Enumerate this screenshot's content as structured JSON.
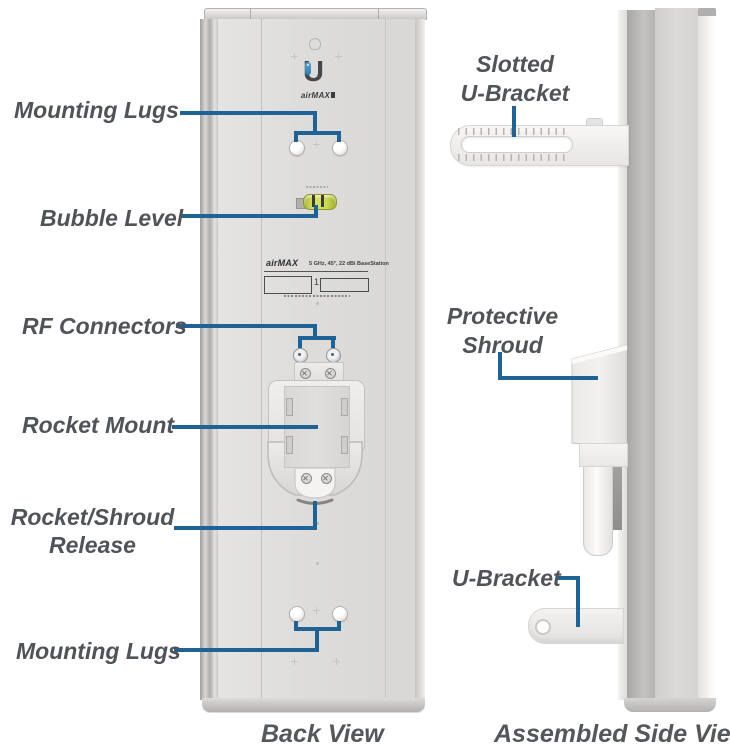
{
  "diagram": {
    "callouts": {
      "mounting_lugs_top": "Mounting Lugs",
      "bubble_level": "Bubble Level",
      "rf_connectors": "RF Connectors",
      "rocket_mount": "Rocket Mount",
      "rocket_shroud_release_line1": "Rocket/Shroud",
      "rocket_shroud_release_line2": "Release",
      "mounting_lugs_bottom": "Mounting Lugs",
      "slotted_u_bracket_line1": "Slotted",
      "slotted_u_bracket_line2": "U-Bracket",
      "protective_shroud_line1": "Protective",
      "protective_shroud_line2": "Shroud",
      "u_bracket": "U-Bracket"
    },
    "captions": {
      "back_view": "Back View",
      "assembled_side_view": "Assembled Side View"
    },
    "device": {
      "logo_letter": "U",
      "logo_brand": "airMAX",
      "sticker_brand": "airMAX",
      "sticker_spec": "5 GHz, 45°, 22 dBi BaseStation",
      "sticker_units_digit": "1"
    },
    "colors": {
      "leader_line": "#1e6296",
      "label_text": "#505357",
      "bubble_green": "#c9d754"
    }
  }
}
